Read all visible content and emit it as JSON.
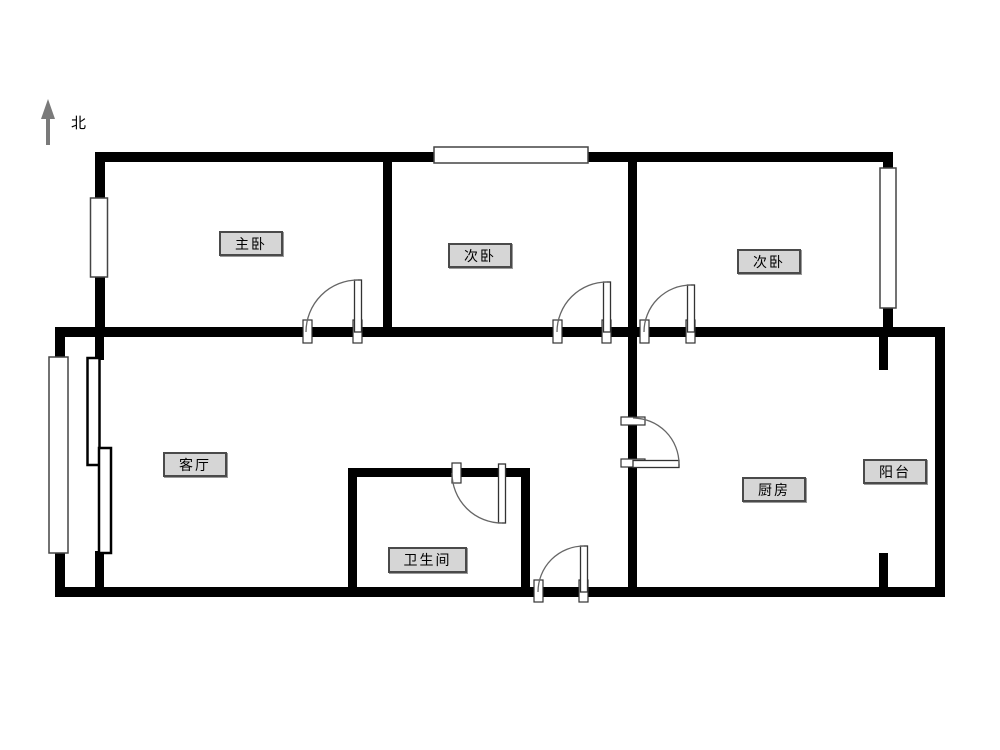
{
  "compass": {
    "label": "北"
  },
  "rooms": [
    {
      "name": "master-bedroom",
      "label": "主卧"
    },
    {
      "name": "second-bedroom-middle",
      "label": "次卧"
    },
    {
      "name": "second-bedroom-right",
      "label": "次卧"
    },
    {
      "name": "living-room",
      "label": "客厅"
    },
    {
      "name": "bathroom",
      "label": "卫生间"
    },
    {
      "name": "kitchen",
      "label": "厨房"
    },
    {
      "name": "balcony",
      "label": "阳台"
    }
  ],
  "colors": {
    "background": "#ffffff",
    "wall": "#000000",
    "window_stroke": "#444444",
    "door_arc": "#666666",
    "door_jamb_stroke": "#333333",
    "label_background": "#d6d6d6",
    "label_border": "#4a4a4a",
    "north_arrow": "#7a7a7a"
  }
}
